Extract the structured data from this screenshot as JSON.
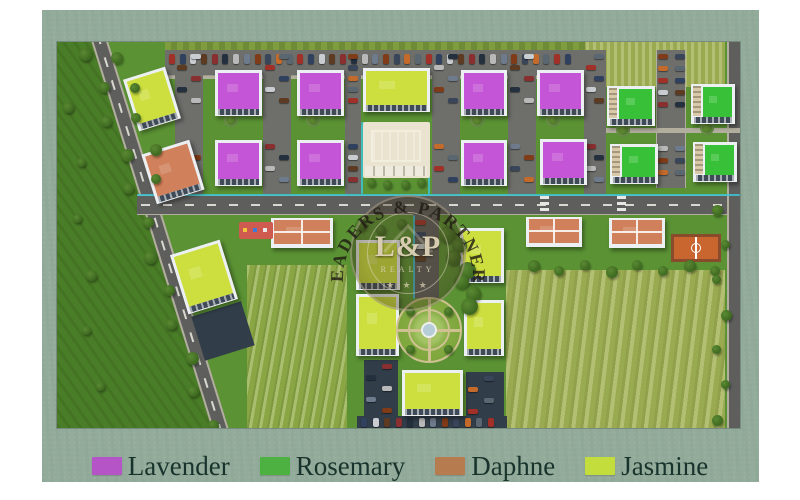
{
  "page": {
    "background": "#ffffff",
    "card_color": "#93ab9b"
  },
  "watermark": {
    "arc_text": "LEADERS & PARTNERS",
    "monogram": "L&P",
    "subtitle": "REALTY",
    "stars": "★ ★ ★"
  },
  "legend": {
    "items": [
      {
        "label": "Lavender",
        "color": "#b554c6"
      },
      {
        "label": "Rosemary",
        "color": "#4cb140"
      },
      {
        "label": "Daphne",
        "color": "#b67c50"
      },
      {
        "label": "Jasmine",
        "color": "#c3dd3c"
      }
    ]
  },
  "site": {
    "palette": {
      "lavender": "#c455d6",
      "rosemary": "#38c138",
      "daphne": "#d0805a",
      "jasmine": "#ccdf3f",
      "white_bldg": "#edf0f2",
      "facade": "#3e4a58",
      "beige": "#d9c9a8",
      "asphalt": "#5e5f5d",
      "parking": "#6e6f6b",
      "sidewalk": "#b3af9f",
      "grass": "#5b9334",
      "field_dark": "#4a7d27",
      "farm": "#89a544",
      "meadow": "#9aaa50",
      "pool": "#2fa9de",
      "deck": "#eae3cf",
      "court": "#c9662f",
      "court_border": "#8a4a2c",
      "cyan": "#3cc4d4",
      "play": "#cf5a50",
      "lot_dark": "#313d49"
    },
    "fields": {
      "farm": [
        190,
        223,
        100,
        163
      ],
      "meadow": [
        449,
        228,
        219,
        158
      ],
      "top_meadow": [
        522,
        0,
        146,
        45
      ]
    },
    "roads": {
      "main": [
        80,
        153,
        603,
        20
      ],
      "drive": [
        356,
        172,
        26,
        84
      ],
      "mid_right": [
        599,
        8,
        30,
        138
      ],
      "right_edge": [
        670,
        0,
        13,
        386
      ],
      "top_parking": [
        108,
        8,
        420,
        26
      ],
      "hedge": [
        108,
        0,
        420,
        9
      ],
      "diagonal": {
        "cx": 103,
        "cy": 193,
        "w": 16,
        "len": 420,
        "rot": -17.3
      }
    },
    "aisles": [
      [
        118,
        28
      ],
      [
        206,
        28
      ],
      [
        288,
        16
      ],
      [
        375,
        28
      ],
      [
        451,
        28
      ],
      [
        527,
        22
      ]
    ],
    "lots": [
      [
        140,
        266,
        52,
        46,
        -17.3
      ],
      [
        307,
        318,
        34,
        62,
        0
      ],
      [
        409,
        330,
        38,
        56,
        0
      ],
      [
        300,
        374,
        150,
        12,
        0
      ]
    ],
    "buildings": [
      [
        158,
        28,
        47,
        46,
        "lavender",
        0
      ],
      [
        240,
        28,
        47,
        46,
        "lavender",
        0
      ],
      [
        404,
        28,
        46,
        46,
        "lavender",
        0
      ],
      [
        480,
        28,
        47,
        46,
        "lavender",
        0
      ],
      [
        158,
        98,
        47,
        46,
        "lavender",
        0
      ],
      [
        240,
        98,
        47,
        46,
        "lavender",
        0
      ],
      [
        404,
        98,
        46,
        46,
        "lavender",
        0
      ],
      [
        483,
        97,
        47,
        46,
        "lavender",
        0
      ],
      [
        550,
        44,
        48,
        40,
        "rosemary",
        0
      ],
      [
        634,
        42,
        44,
        40,
        "rosemary",
        0
      ],
      [
        553,
        102,
        48,
        40,
        "rosemary",
        0
      ],
      [
        636,
        100,
        44,
        40,
        "rosemary",
        0
      ],
      [
        306,
        26,
        67,
        44,
        "jasmine",
        0
      ],
      [
        73,
        30,
        44,
        54,
        "jasmine",
        -17.3
      ],
      [
        91,
        104,
        50,
        52,
        "daphne",
        -17.3
      ],
      [
        121,
        204,
        52,
        62,
        "jasmine",
        -17.3
      ],
      [
        214,
        176,
        62,
        30,
        "daphne",
        0
      ],
      [
        469,
        175,
        56,
        30,
        "daphne",
        0
      ],
      [
        552,
        176,
        56,
        30,
        "daphne",
        0
      ],
      [
        299,
        198,
        44,
        50,
        "jasmine",
        0
      ],
      [
        403,
        186,
        44,
        55,
        "jasmine",
        0
      ],
      [
        299,
        252,
        43,
        62,
        "jasmine",
        0
      ],
      [
        407,
        258,
        40,
        56,
        "jasmine",
        0
      ],
      [
        345,
        328,
        61,
        46,
        "jasmine",
        0
      ]
    ],
    "pool": {
      "deck": [
        306,
        80,
        67,
        56
      ],
      "water": [
        314,
        88,
        50,
        32
      ],
      "pergola": [
        308,
        124,
        62,
        10
      ]
    },
    "garden": {
      "cx": 372,
      "cy": 288,
      "r": 33
    },
    "court": [
      614,
      192,
      50,
      28
    ],
    "playground": [
      182,
      180,
      34,
      17
    ],
    "tree_rows": [
      [
        26,
        6,
        146,
        378,
        12,
        11
      ],
      [
        58,
        10,
        98,
        132,
        5,
        10
      ],
      [
        471,
        221,
        653,
        221,
        8,
        10
      ],
      [
        659,
        163,
        659,
        373,
        7,
        9
      ],
      [
        386,
        184,
        408,
        256,
        7,
        15
      ],
      [
        298,
        180,
        340,
        180,
        3,
        10
      ],
      [
        10,
        60,
        34,
        340,
        6,
        9
      ]
    ],
    "cyan_lines": [
      [
        80,
        152,
        603,
        2
      ],
      [
        356,
        173,
        2,
        84
      ],
      [
        304,
        82,
        2,
        70
      ],
      [
        371,
        82,
        2,
        70
      ],
      [
        304,
        80,
        69,
        2
      ]
    ],
    "crosswalks": [
      [
        483,
        154,
        9,
        18
      ],
      [
        560,
        154,
        9,
        18
      ]
    ],
    "hedge_circles": [
      [
        174,
        78
      ],
      [
        256,
        78
      ],
      [
        420,
        78
      ],
      [
        496,
        78
      ],
      [
        566,
        88
      ],
      [
        650,
        86
      ]
    ],
    "car_colors": [
      "#a03028",
      "#30415f",
      "#c9cdd1",
      "#5d3a22",
      "#8a2f2f",
      "#24303e",
      "#b9b9b9",
      "#6e7b8c",
      "#803c18",
      "#39465a",
      "#c46a2a",
      "#5b6770"
    ]
  }
}
